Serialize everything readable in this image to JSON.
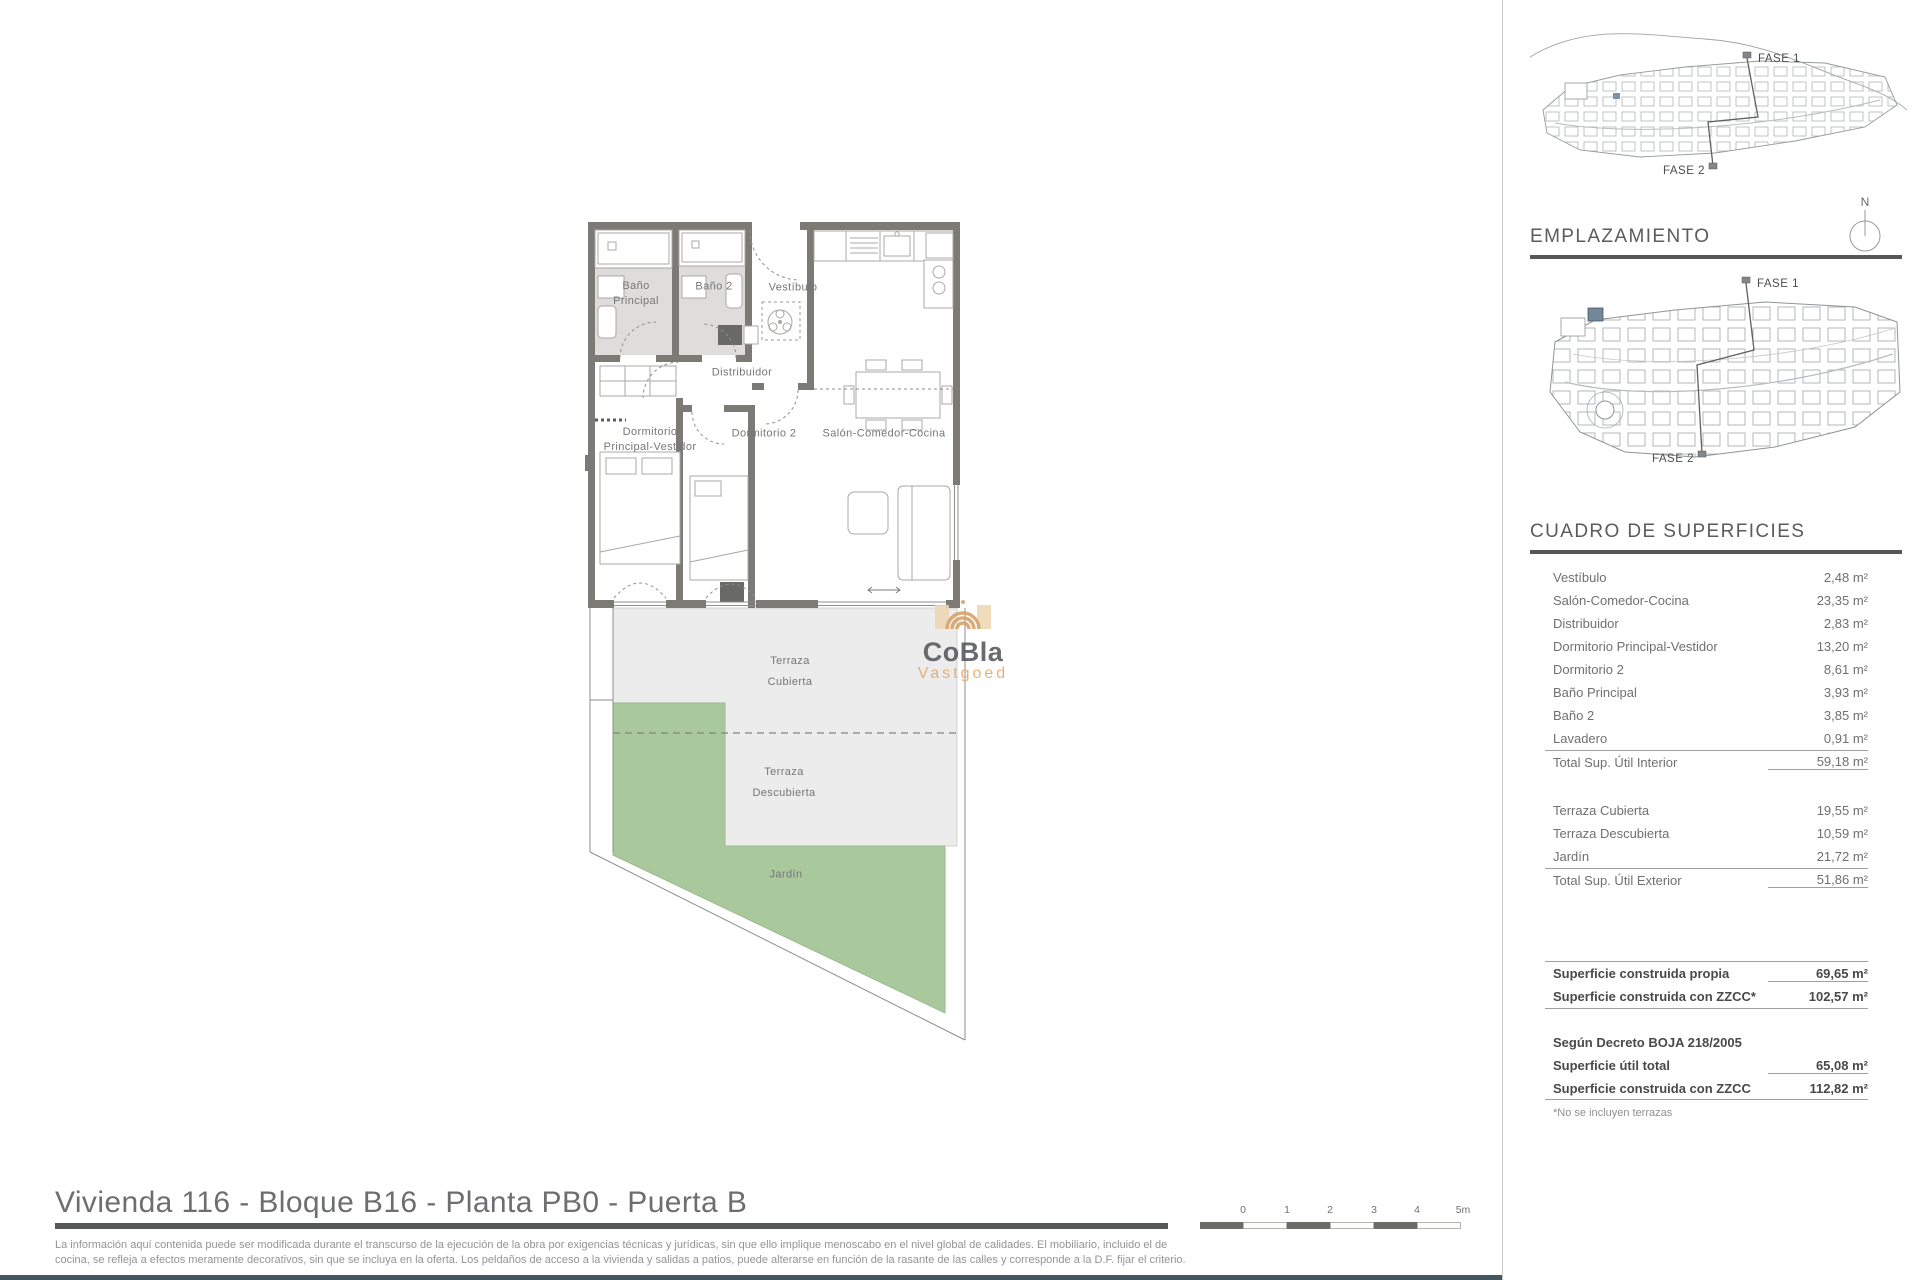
{
  "maps": {
    "section_title": "EMPLAZAMIENTO",
    "compass": "N",
    "fase1": "FASE 1",
    "fase2": "FASE 2"
  },
  "surfaces": {
    "title": "CUADRO DE SUPERFICIES",
    "interior_rows": [
      {
        "label": "Vestíbulo",
        "value": "2,48 m²"
      },
      {
        "label": "Salón-Comedor-Cocina",
        "value": "23,35 m²"
      },
      {
        "label": "Distribuidor",
        "value": "2,83 m²"
      },
      {
        "label": "Dormitorio Principal-Vestidor",
        "value": "13,20 m²"
      },
      {
        "label": "Dormitorio 2",
        "value": "8,61 m²"
      },
      {
        "label": "Baño Principal",
        "value": "3,93 m²"
      },
      {
        "label": "Baño 2",
        "value": "3,85 m²"
      },
      {
        "label": "Lavadero",
        "value": "0,91 m²"
      }
    ],
    "interior_total": {
      "label": "Total Sup. Útil Interior",
      "value": "59,18 m²"
    },
    "exterior_rows": [
      {
        "label": "Terraza Cubierta",
        "value": "19,55 m²"
      },
      {
        "label": "Terraza Descubierta",
        "value": "10,59 m²"
      },
      {
        "label": "Jardín",
        "value": "21,72 m²"
      }
    ],
    "exterior_total": {
      "label": "Total Sup. Útil Exterior",
      "value": "51,86 m²"
    },
    "built_rows": [
      {
        "label": "Superficie construida propia",
        "value": "69,65 m²"
      },
      {
        "label": "Superficie construida con ZZCC*",
        "value": "102,57 m²"
      }
    ],
    "decree_heading": "Según Decreto BOJA 218/2005",
    "decree_rows": [
      {
        "label": "Superficie útil total",
        "value": "65,08 m²"
      },
      {
        "label": "Superficie construida con ZZCC",
        "value": "112,82 m²"
      }
    ],
    "footnote": "*No se incluyen terrazas"
  },
  "floorplan": {
    "labels": {
      "bano_principal_1": "Baño",
      "bano_principal_2": "Principal",
      "bano_2": "Baño 2",
      "vestibulo": "Vestíbulo",
      "distribuidor": "Distribuidor",
      "dormitorio_principal_1": "Dormitorio",
      "dormitorio_principal_2": "Principal-Vestidor",
      "dormitorio_2": "Dormitorio 2",
      "salon": "Salón-Comedor-Cocina",
      "terraza_cubierta_1": "Terraza",
      "terraza_cubierta_2": "Cubierta",
      "terraza_descubierta_1": "Terraza",
      "terraza_descubierta_2": "Descubierta",
      "jardin": "Jardín"
    },
    "colors": {
      "wall": "#7b7a75",
      "bath_floor": "#dedddb",
      "terrace": "#ebeceb",
      "garden": "#a9c89c",
      "accent_unit": "#72879a"
    }
  },
  "watermark": {
    "name": "CoBla",
    "subtitle": "Vastgoed"
  },
  "footer": {
    "title": "Vivienda 116 - Bloque B16 - Planta PB0 - Puerta B",
    "disclaimer_1": "La información aquí contenida puede ser modificada durante el transcurso de la ejecución de la obra por exigencias técnicas y jurídicas, sin que ello implique menoscabo en el nivel global de calidades. El mobiliario, incluido el de",
    "disclaimer_2": "cocina, se refleja a efectos meramente decorativos, sin que se incluya en la oferta. Los peldaños de acceso a la vivienda y salidas a patios, puede alterarse en función de la rasante de las calles y corresponde a la D.F. fijar el criterio.",
    "scale_labels": [
      "0",
      "1",
      "2",
      "3",
      "4",
      "5m"
    ]
  }
}
